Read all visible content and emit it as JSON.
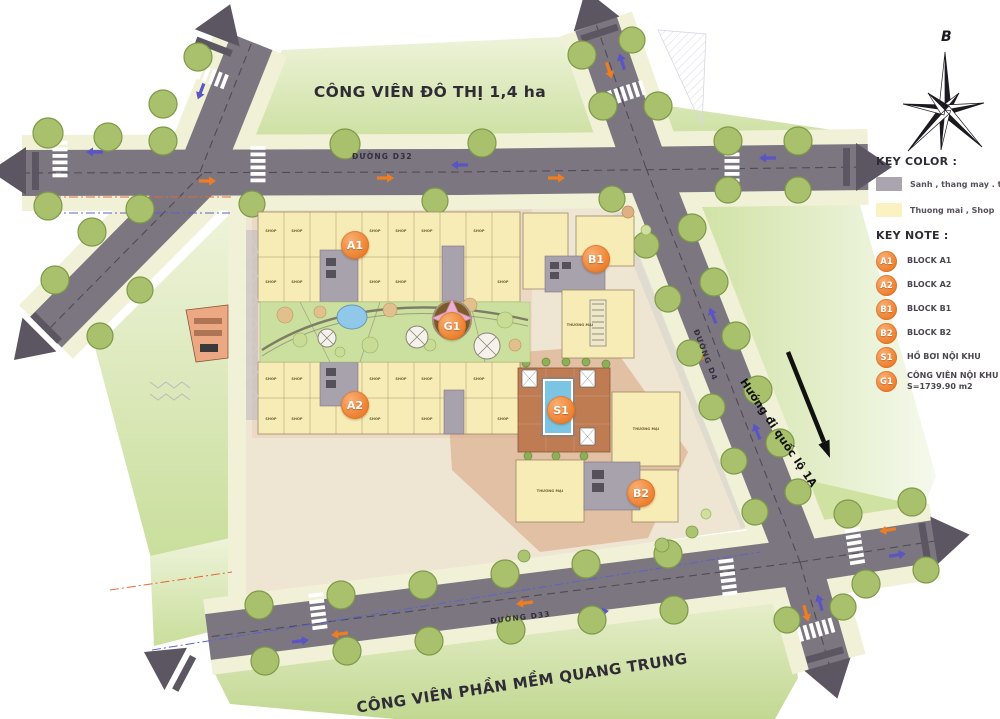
{
  "titles": {
    "top_park": "CÔNG VIÊN ĐÔ THỊ 1,4 ha",
    "bottom_park": "CÔNG VIÊN PHẦN MỀM QUANG TRUNG"
  },
  "roads": {
    "d32": "ĐƯỜNG D32",
    "d33": "ĐƯỜNG D33",
    "d4": "ĐƯỜNG D4",
    "highway_direction": "Hướng đi quốc lộ 1A"
  },
  "compass": {
    "north_label": "B"
  },
  "legend": {
    "key_color_title": "KEY COLOR :",
    "key_color_items": [
      {
        "color": "#aaa4ae",
        "label": "Sanh , thang may . thang bo"
      },
      {
        "color": "#faf3c1",
        "label": "Thuong mai , Shop"
      }
    ],
    "key_note_title": "KEY NOTE :",
    "key_note_items": [
      {
        "code": "A1",
        "label": "BLOCK A1"
      },
      {
        "code": "A2",
        "label": "BLOCK A2"
      },
      {
        "code": "B1",
        "label": "BLOCK B1"
      },
      {
        "code": "B2",
        "label": "BLOCK B2"
      },
      {
        "code": "S1",
        "label": "HỒ BƠI NỘI KHU"
      },
      {
        "code": "G1",
        "label": "CÔNG VIÊN NỘI KHU",
        "sublabel": "S=1739.90 m2"
      }
    ],
    "badge_color": "#ee8136"
  },
  "map_labels": {
    "shop": "SHOP",
    "commercial": "THƯƠNG MẠI"
  }
}
